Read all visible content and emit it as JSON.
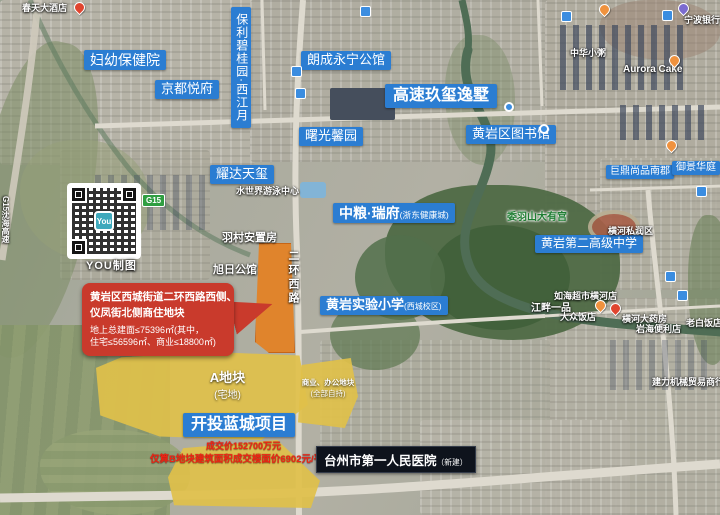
{
  "annotations": {
    "communities": [
      "妇幼保健院",
      "保利碧桂园·西江月",
      "朗成永宁公馆",
      "京都悦府",
      "高速玖玺逸墅",
      "曙光馨园",
      "黄岩区图书馆",
      "耀达天玺",
      "巨鼎尚品南郡",
      "御景华庭",
      "黄岩第二高级中学",
      "开投蓝城项目"
    ],
    "zhongliang": {
      "main": "中粮·瑞府",
      "suffix": "(浙东健康城)"
    },
    "shiyan": {
      "main": "黄岩实验小学",
      "suffix": "(西城校区)"
    },
    "hospital": {
      "main": "台州市第一人民医院",
      "suffix": "（新建）"
    },
    "mountain_temple": "委羽山大有宫"
  },
  "callout": {
    "title1": "黄岩区西城街道二环西路西侧、",
    "title2": "仪凤街北侧商住地块",
    "detail1": "地上总建面≤75396㎡(其中，",
    "detail2": "住宅≤56596㎡、商业≤18800㎡)"
  },
  "deal": {
    "price": "成交价152700万元",
    "floor_price": "仅算B地块建筑面积成交楼面价6902元/平"
  },
  "parcels": {
    "a": "A地块",
    "a_sub": "(宅地)",
    "office": "商业、办公地块",
    "office_sub": "(全部自持)"
  },
  "roads": {
    "erhuanxilu": "二环西路",
    "g15": "G15",
    "g15_full": "G15沈海高速"
  },
  "basemap": [
    "羽村安置房",
    "旭日公馆",
    "水世界游泳中心",
    "江畔一品",
    "如海超市横河店",
    "大众饭店",
    "横河大药房",
    "岩海便利店",
    "老白饭店",
    "建力机械贸易商行",
    "横河私润区",
    "Aurora Cake",
    "宁波银行",
    "中华小粥",
    "春天大酒店"
  ],
  "watermark": {
    "credit": "YOU制图",
    "logo": "You"
  },
  "icons": {
    "map_pin": "drop-pin",
    "bus_stop": "blue-square",
    "metro_station": "blue-circle"
  },
  "colors": {
    "label_blue": "#2b7dd2",
    "callout_red": "#c93a2c",
    "parcel_orange": "#e0842c",
    "parcel_yellow": "#dfc04a",
    "deal_red": "#ee2414",
    "hospital_black": "#0e131c"
  }
}
